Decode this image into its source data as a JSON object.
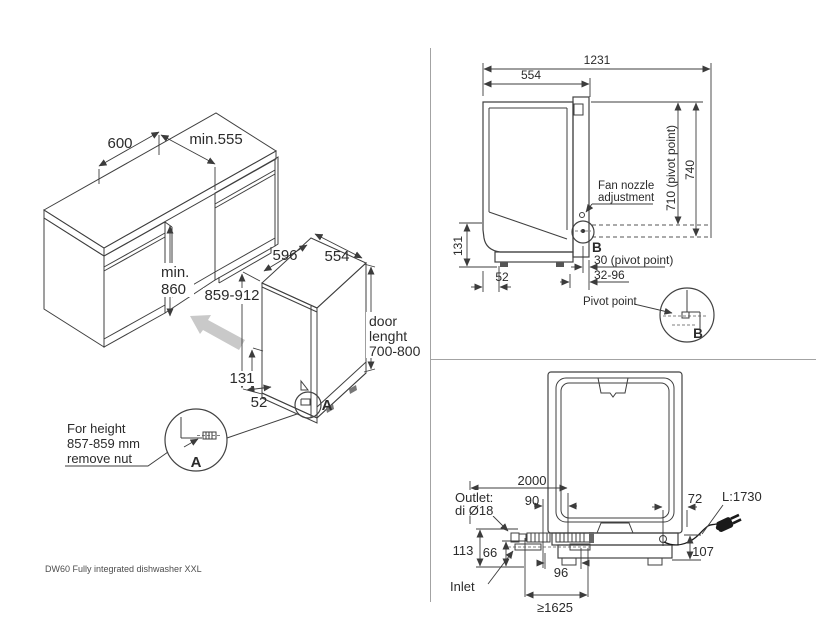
{
  "footer": {
    "model_label": "DW60 Fully integrated dishwasher XXL"
  },
  "colors": {
    "unit_front": "#a8a8a8",
    "unit_side": "#b1b1b1",
    "unit_top": "#bdbdbd",
    "unit_plinth": "#d8d8d8",
    "sideview_body": "#b3b3b3",
    "rear_body": "#b6b6b6",
    "move_arrow": "#c9c9c9"
  },
  "iso_view": {
    "dims": {
      "niche_width": "600",
      "niche_depth": "min.555",
      "niche_height_l1": "min.",
      "niche_height_l2": "860",
      "unit_width": "596",
      "unit_depth": "554",
      "unit_height": "859-912",
      "base_height": "131",
      "foot_offset": "52",
      "door_l1": "door",
      "door_l2": "lenght",
      "door_l3": "700-800"
    },
    "detail_a": {
      "marker": "A",
      "label": "A",
      "note_l1": "For height",
      "note_l2": "857-859 mm",
      "note_l3": "remove nut"
    }
  },
  "side_view": {
    "dims": {
      "total_depth_door_open": "1231",
      "depth": "554",
      "pivot_height": "710 (pivot point)",
      "niche_ref_height": "740",
      "base_height": "131",
      "foot_offset": "52",
      "pivot_offset": "30 (pivot point)",
      "adjust_range": "32-96"
    },
    "fan_nozzle_l1": "Fan nozzle",
    "fan_nozzle_l2": "adjustment",
    "detail_b": {
      "marker": "B",
      "label": "B",
      "pivot_label": "Pivot point"
    }
  },
  "rear_view": {
    "dims": {
      "drain_hose_length": "2000",
      "outlet_position": "90",
      "cord_position": "72",
      "cord_length": "L:1730",
      "outlet_height": "113",
      "inlet_height": "66",
      "base_height": "107",
      "hose_span": "96",
      "min_distance": "≥1625"
    },
    "outlet_l1": "Outlet:",
    "outlet_l2": "di Ø18",
    "inlet_label": "Inlet"
  }
}
